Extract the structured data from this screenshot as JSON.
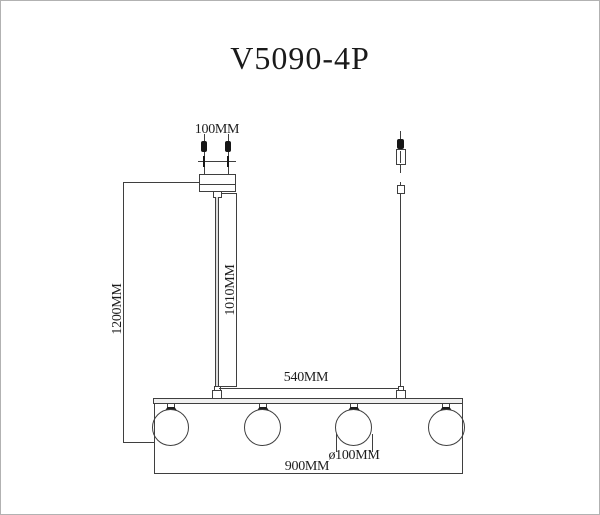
{
  "title": "V5090-4P",
  "labels": {
    "canopy_width": "100MM",
    "overall_drop": "1200MM",
    "rod_length": "1010MM",
    "rod_to_wire_spacing": "540MM",
    "bar_length": "900MM",
    "shade_diameter": "ø100MM"
  },
  "colors": {
    "line": "#3f3f3f",
    "text": "#1e1e1e",
    "frame": "#b2b2b2",
    "background": "#ffffff"
  }
}
